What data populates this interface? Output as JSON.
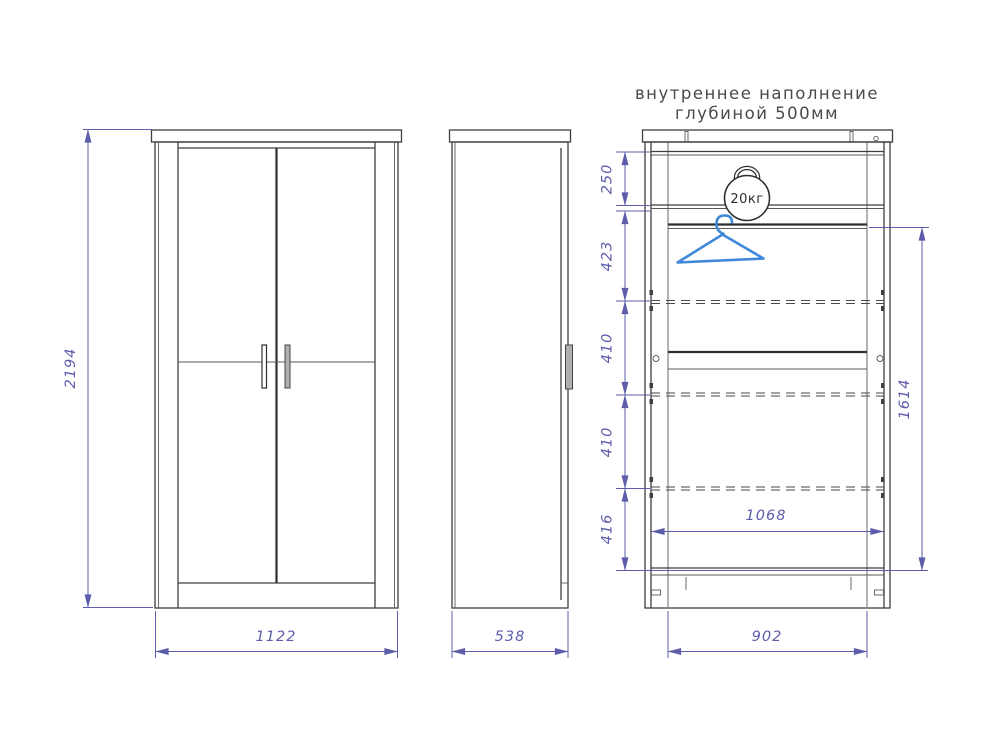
{
  "title": {
    "line1": "внутреннее наполнение",
    "line2": "глубиной 500мм"
  },
  "front_view": {
    "height": "2194",
    "width": "1122"
  },
  "side_view": {
    "depth": "538"
  },
  "internal_view": {
    "section_heights": [
      "250",
      "423",
      "410",
      "410",
      "416"
    ],
    "hanging_height": "1614",
    "interior_width": "1068",
    "base_width": "902",
    "max_load": "20кг"
  },
  "icons": {
    "kettlebell": "kettlebell-weight-20kg",
    "hanger": "clothes-hanger"
  },
  "colors": {
    "outline": "#3f3f3f",
    "dimension": "#5d5dab",
    "hanger_blue": "#3f87d9",
    "handle_fill": "#b0b0b0"
  }
}
